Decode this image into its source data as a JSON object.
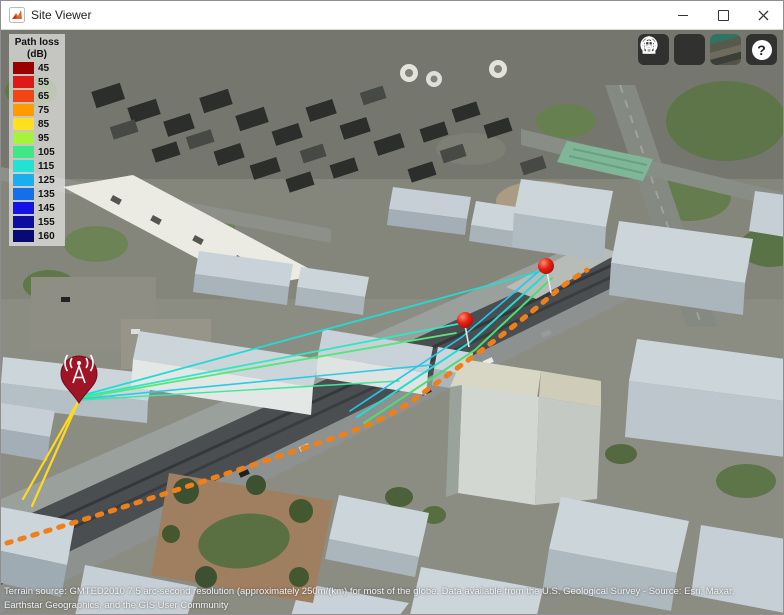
{
  "window": {
    "title": "Site Viewer"
  },
  "legend": {
    "title": "Path loss",
    "unit": "(dB)",
    "items": [
      {
        "label": "45",
        "color": "#9b0000"
      },
      {
        "label": "55",
        "color": "#e01818"
      },
      {
        "label": "65",
        "color": "#f44414"
      },
      {
        "label": "75",
        "color": "#ff9b00"
      },
      {
        "label": "85",
        "color": "#ffe01e"
      },
      {
        "label": "95",
        "color": "#a6f23c"
      },
      {
        "label": "105",
        "color": "#3fe887"
      },
      {
        "label": "115",
        "color": "#22e2d4"
      },
      {
        "label": "125",
        "color": "#18aef0"
      },
      {
        "label": "135",
        "color": "#1470e8"
      },
      {
        "label": "145",
        "color": "#1414e8"
      },
      {
        "label": "155",
        "color": "#0d0da2"
      },
      {
        "label": "160",
        "color": "#090974"
      }
    ]
  },
  "toolbar": {
    "buttons": [
      "home",
      "globe",
      "basemap",
      "help"
    ],
    "help_label": "?"
  },
  "markers": {
    "transmitter_count": 1,
    "receiver_count": 2,
    "transmitter_color": "#a01525",
    "receiver_color": "#e51f10"
  },
  "rays": {
    "colors": {
      "yellow": "#ffd91e",
      "orange_trail": "#ef7f18",
      "cyan": "#22dcd4",
      "green": "#42e07c",
      "blue": "#1fc8f0"
    }
  },
  "attribution": {
    "line1": "Terrain source: GMTED2010 7.5 arc-second resolution (approximately 250m/(km) for most of the globe. Data available from the U.S. Geological Survey - Source: Esri, Maxar,",
    "line2": "Earthstar Geographics, and the GIS User Community"
  }
}
